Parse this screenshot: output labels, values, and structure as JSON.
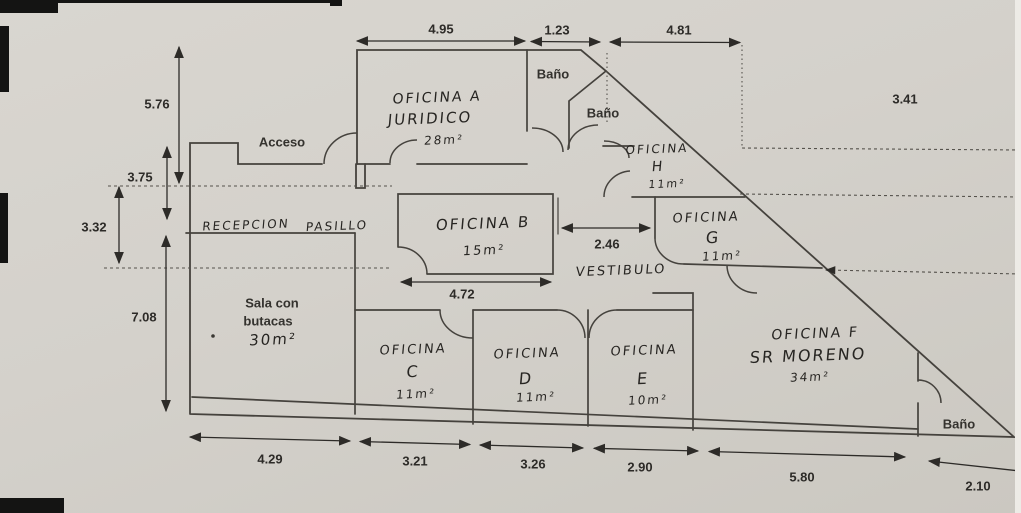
{
  "document": {
    "title": "Plano de oficinas (escaneado)",
    "entrance_label": "Acceso"
  },
  "rooms": {
    "oficina_a": {
      "line1": "OFICINA A",
      "line2": "JURIDICO",
      "area": "28m²"
    },
    "oficina_b": {
      "line1": "OFICINA B",
      "area": "15m²"
    },
    "oficina_c": {
      "line1": "OFICINA",
      "line2": "C",
      "area": "11m²"
    },
    "oficina_d": {
      "line1": "OFICINA",
      "line2": "D",
      "area": "11m²"
    },
    "oficina_e": {
      "line1": "OFICINA",
      "line2": "E",
      "area": "10m²"
    },
    "oficina_f": {
      "line1": "OFICINA F",
      "line2": "SR MORENO",
      "area": "34m²"
    },
    "oficina_g": {
      "line1": "OFICINA",
      "line2": "G",
      "area": "11m²"
    },
    "oficina_h": {
      "line1": "OFICINA",
      "line2": "H",
      "area": "11m²"
    },
    "bano_top": "Baño",
    "bano_mid": "Baño",
    "bano_bottom_right": "Baño",
    "recepcion": "RECEPCION",
    "pasillo": "PASILLO",
    "vestibulo": "VESTIBULO",
    "acceso": "Acceso",
    "sala": {
      "line1": "Sala con",
      "line2": "butacas",
      "area": "30m²"
    }
  },
  "dimensions": {
    "top": [
      "4.95",
      "1.23",
      "4.81"
    ],
    "top_right": "3.41",
    "left": [
      "5.76",
      "3.75",
      "3.32",
      "7.08"
    ],
    "bottom": [
      "4.29",
      "3.21",
      "3.26",
      "2.90",
      "5.80",
      "2.10"
    ],
    "inner": {
      "vestibulo_width": "2.46",
      "oficina_b_width": "4.72"
    }
  },
  "colors": {
    "paper": "#d5d2cc",
    "wall_ink": "#45423d",
    "dim_ink": "#2d2b28",
    "scan_artifact": "#141413"
  }
}
